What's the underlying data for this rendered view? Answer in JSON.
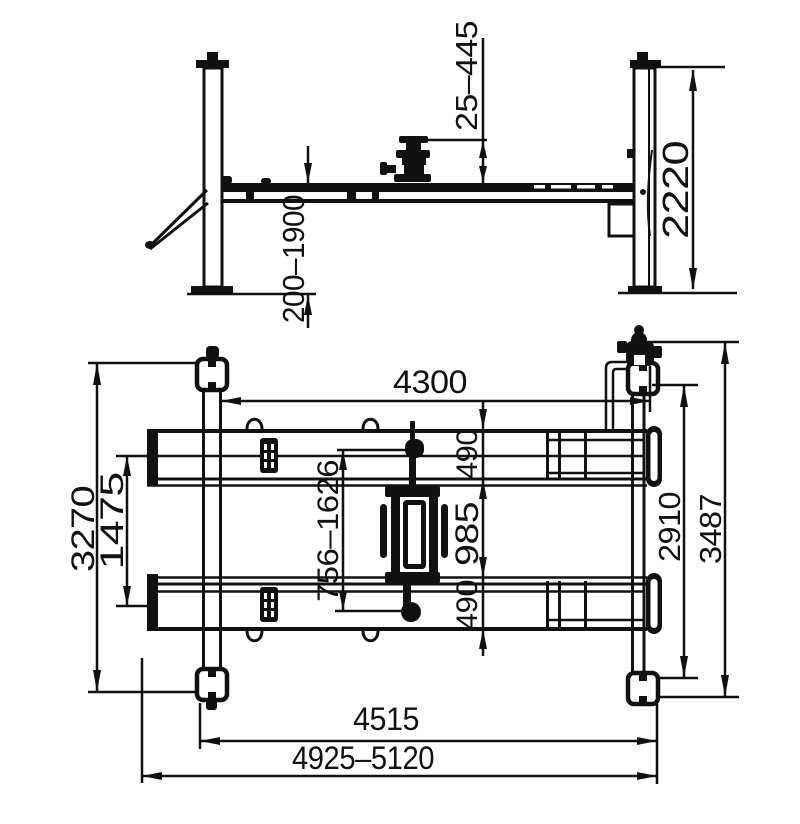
{
  "side_view": {
    "jack_pad_travel": "25–445",
    "column_height": "2220",
    "lifting_height_range": "200–1900"
  },
  "plan_view": {
    "inner_length": "4300",
    "runway_width_top": "490",
    "runway_gap": "985",
    "runway_width_bottom": "490",
    "runway_adjust_range": "756–1626",
    "runway_center_distance": "1475",
    "frame_width": "3270",
    "inner_width": "2910",
    "overall_width": "3487",
    "post_spacing_length": "4515",
    "overall_length_range": "4925–5120"
  }
}
